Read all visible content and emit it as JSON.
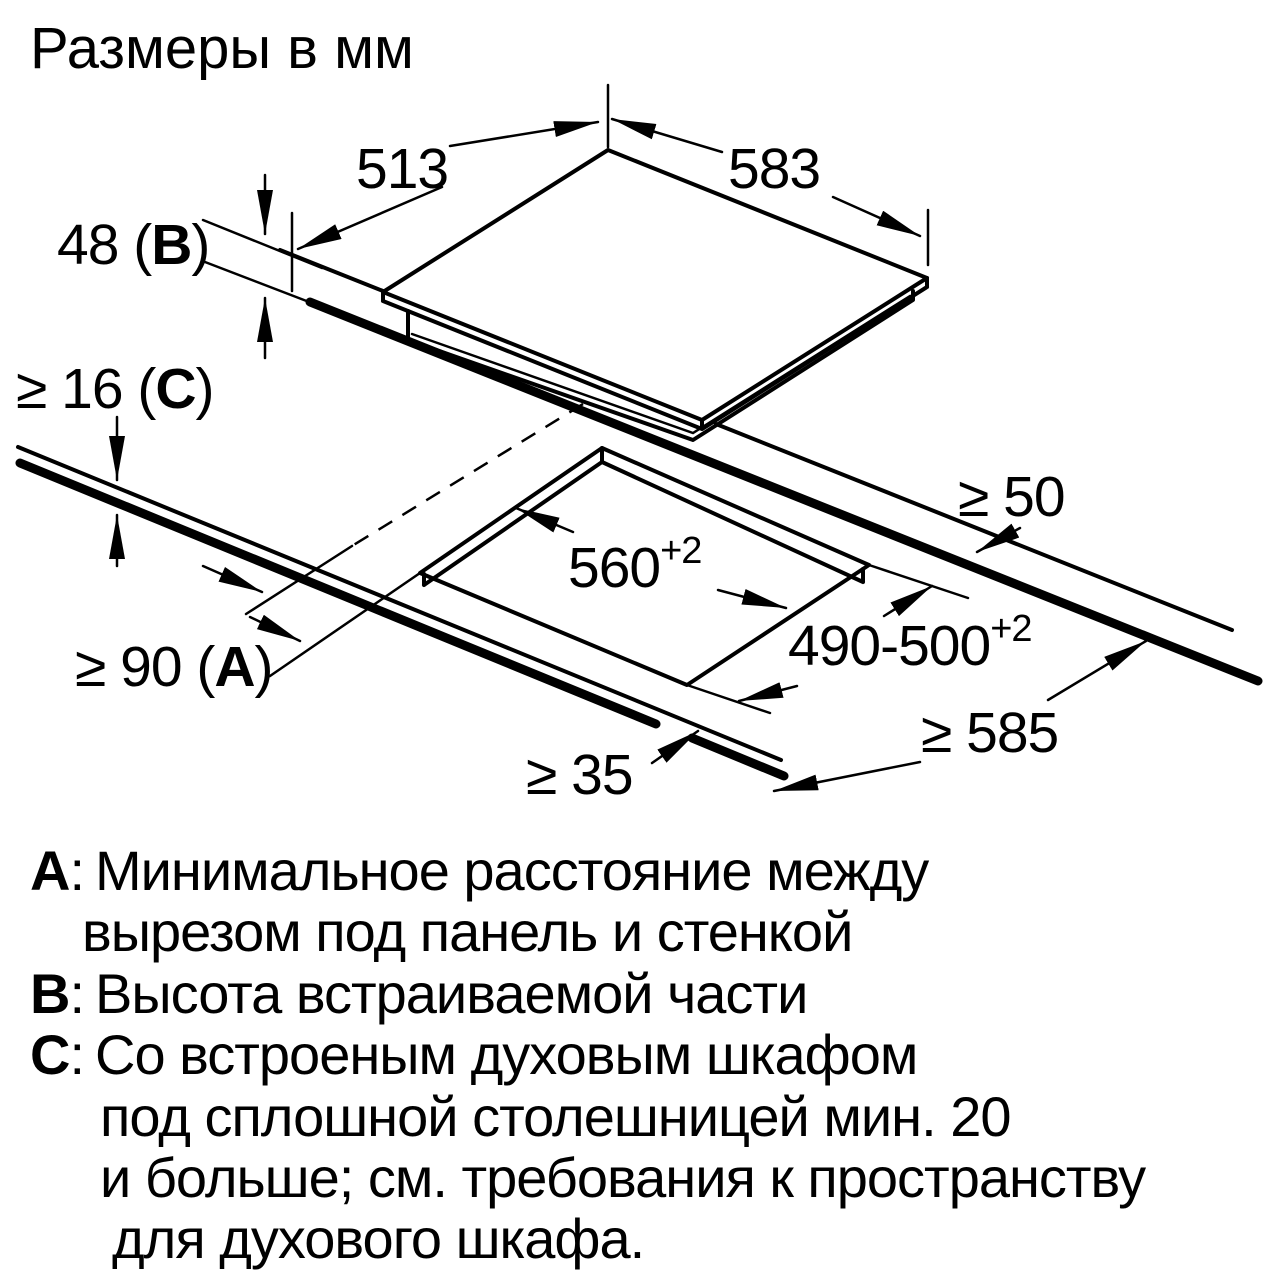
{
  "title": "Размеры в мм",
  "colors": {
    "line": "#000000",
    "background": "#ffffff"
  },
  "dimensions": {
    "glass_depth": "513",
    "glass_width": "583",
    "build_in_height": {
      "pre": "48 (",
      "letter": "B",
      "post": ")"
    },
    "worktop_thickness": {
      "pre": "≥ 16 (",
      "letter": "C",
      "post": ")"
    },
    "rear_distance": {
      "pre": "≥ 90 (",
      "letter": "A",
      "post": ")"
    },
    "side_clearance": "≥ 50",
    "cutout_width": {
      "value": "560",
      "sup": "+2"
    },
    "cutout_depth": {
      "value": "490-500",
      "sup": "+2"
    },
    "front_clearance": "≥ 35",
    "worktop_depth": "≥ 585"
  },
  "legend": {
    "lines": [
      {
        "letter": "А",
        "sep": ": ",
        "text": "Минимальное расстояние между"
      },
      {
        "letter": "",
        "sep": "",
        "text": "вырезом под панель и стенкой"
      },
      {
        "letter": "В",
        "sep": ": ",
        "text": "Высота встраиваемой части"
      },
      {
        "letter": "С",
        "sep": ": ",
        "text": "Со встроеным духовым шкафом"
      },
      {
        "letter": "",
        "sep": "",
        "text": "под сплошной столешницей мин. 20"
      },
      {
        "letter": "",
        "sep": "",
        "text": "и больше; см. требования к пространству"
      },
      {
        "letter": "",
        "sep": "",
        "text": "для духового шкафа."
      }
    ]
  }
}
